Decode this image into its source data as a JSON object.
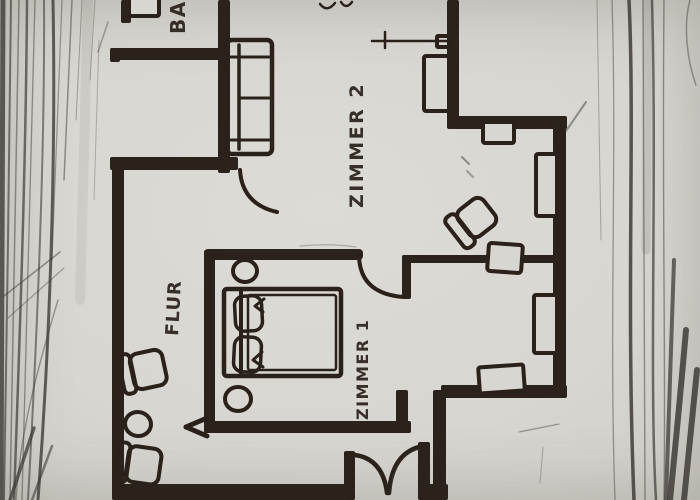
{
  "artifact": {
    "kind": "hand-drawn floor plan sketch",
    "medium": "dark ink on gray paper, pencil page edges left and right"
  },
  "palette": {
    "paper": "#d8d6d1",
    "ink": "#29211a",
    "pencil": "#3f3b37"
  },
  "labels": {
    "bathroom": "BAD",
    "room2": "ZIMMER 2",
    "room1": "ZIMMER 1",
    "hallway": "FLUR"
  },
  "plan": {
    "label_rotation_deg": -90,
    "rooms_visible": [
      "BAD (cut off at top edge)",
      "ZIMMER 2",
      "ZIMMER 1",
      "FLUR"
    ],
    "furniture": {
      "sofa_two_seat": 1,
      "double_bed_with_two_pillows": 1,
      "round_nightstands": 2,
      "hall_armchairs": 2,
      "hall_round_table": 1,
      "room2_armchair": 1,
      "room2_side_table": 1,
      "window_marks": 6,
      "single_door_arcs": 2,
      "entrance": "double swing door at bottom",
      "entrance_arrow_direction": "left"
    }
  }
}
